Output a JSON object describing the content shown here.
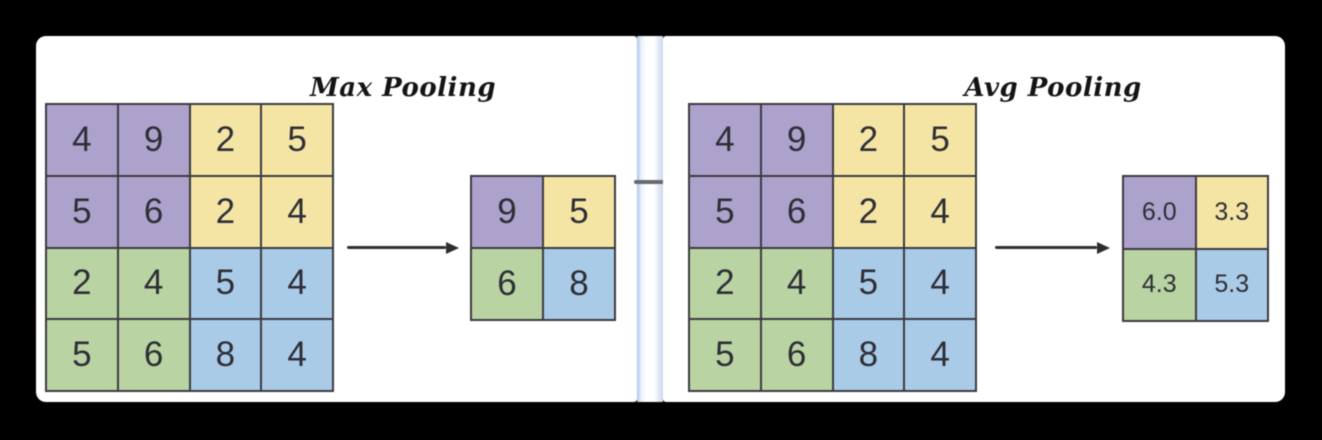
{
  "diagram": {
    "left": {
      "title": "Max Pooling",
      "input_grid": {
        "rows": [
          [
            "4",
            "9",
            "2",
            "5"
          ],
          [
            "5",
            "6",
            "2",
            "4"
          ],
          [
            "2",
            "4",
            "5",
            "4"
          ],
          [
            "5",
            "6",
            "8",
            "4"
          ]
        ]
      },
      "output_grid": {
        "rows": [
          [
            "9",
            "5"
          ],
          [
            "6",
            "8"
          ]
        ]
      }
    },
    "right": {
      "title": "Avg Pooling",
      "input_grid": {
        "rows": [
          [
            "4",
            "9",
            "2",
            "5"
          ],
          [
            "5",
            "6",
            "2",
            "4"
          ],
          [
            "2",
            "4",
            "5",
            "4"
          ],
          [
            "5",
            "6",
            "8",
            "4"
          ]
        ]
      },
      "output_grid": {
        "rows": [
          [
            "6.0",
            "3.3"
          ],
          [
            "4.3",
            "5.3"
          ]
        ]
      }
    },
    "colors": {
      "purple": "#ada2cc",
      "yellow": "#f5e5a5",
      "green": "#b9d3a3",
      "blue": "#aacbe8",
      "grid_line": "#3b3b41",
      "number": "#2e2e36",
      "title": "#141414",
      "arrow": "#2e2e2e",
      "divider_blue": "#a9c4e8",
      "panel_bg": "#ffffff",
      "canvas_bg": "#000000"
    }
  }
}
